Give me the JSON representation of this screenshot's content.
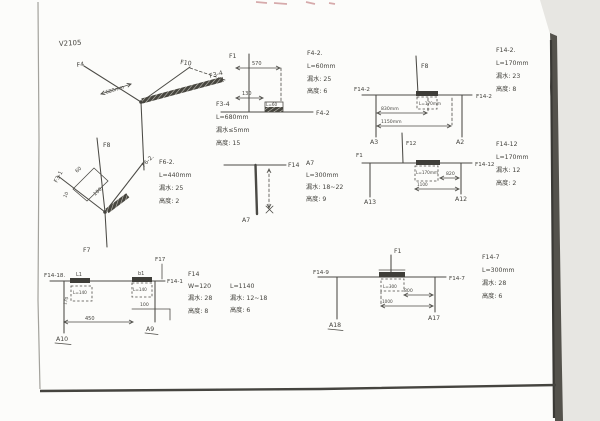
{
  "page": {
    "code": "V2105"
  },
  "d1": {
    "f4": "F4",
    "f10": "F10",
    "f34": "F3-4",
    "dim": "680mm",
    "note": [
      "F3-4",
      "L=680mm",
      "漏水≤5mm",
      "高度: 15"
    ]
  },
  "d2": {
    "f8": "F8",
    "f31": "F3-1",
    "f62": "F6-2.",
    "f7": "F7",
    "dim60": "60",
    "dim100": "100",
    "dim10": "10",
    "note": [
      "F6-2.",
      "L=440mm",
      "漏水: 25",
      "高度: 2"
    ]
  },
  "d3": {
    "f14": "F14",
    "a7": "A7",
    "note": [
      "A7",
      "L=300mm",
      "漏水: 18~22",
      "高度: 9"
    ]
  },
  "d4": {
    "f12": "F12",
    "f1": "F1",
    "f1412": "F14-12",
    "a13": "A13",
    "a12": "A12",
    "box": "L=170mm",
    "dim820": "820",
    "dim1100": "1100",
    "note": [
      "F14-12",
      "L=170mm",
      "漏水: 12",
      "高度: 2"
    ]
  },
  "d5": {
    "f1": "F1",
    "f42": "F4-2",
    "dim570": "570",
    "dim130": "130",
    "box": "L=60",
    "note": [
      "F4-2.",
      "L=60mm",
      "漏水: 25",
      "高度: 6"
    ]
  },
  "d6": {
    "f8": "F8",
    "left": "F14-2",
    "right": "F14-2",
    "a3": "A3",
    "a2": "A2",
    "box": "L=170mm",
    "dim830": "830mm",
    "dim1150": "1150mm",
    "note": [
      "F14-2.",
      "L=170mm",
      "漏水: 23",
      "高度: 8"
    ]
  },
  "d7": {
    "f17": "F17",
    "left": "F14-18.",
    "right": "F14-1",
    "l1": "L1",
    "b1": "b1",
    "box1": "L=140",
    "box2": "L=140",
    "dim170": "170",
    "dim450": "450",
    "dim100": "100",
    "a10": "A10",
    "a9": "A9",
    "note1": [
      "F14",
      "W=120",
      "漏水: 28",
      "高度: 8"
    ],
    "note2": [
      "L=1140",
      "漏水: 12~18",
      "高度: 6"
    ]
  },
  "d8": {
    "f1": "F1",
    "left": "F14-9",
    "right": "F14-7",
    "box": "L=300",
    "dim800": "800",
    "dim1000": "1000",
    "a18": "A18",
    "a17": "A17",
    "note": [
      "F14-7",
      "L=300mm",
      "漏水: 28",
      "高度: 6"
    ]
  }
}
